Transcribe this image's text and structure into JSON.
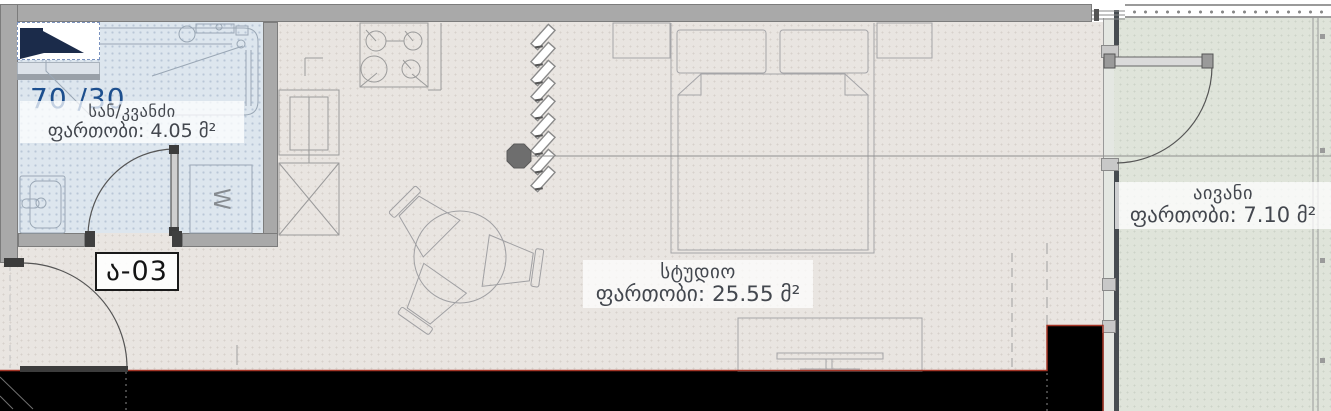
{
  "plan": {
    "unit_code": "ა-03",
    "ratio": "70 /30",
    "rooms": {
      "bathroom": {
        "name": "სან/კვანძი",
        "area": "ფართობი: 4.05 მ²"
      },
      "studio": {
        "name": "სტუდიო",
        "area": "ფართობი: 25.55 მ²"
      },
      "balcony": {
        "name": "აივანი",
        "area": "ფართობი: 7.10 მ²"
      }
    },
    "symbols": {
      "washer": "W"
    }
  },
  "colors": {
    "wall": "#a9a9a9",
    "wall-edge": "#7c7c7c",
    "floor": "#e9e5e1",
    "bath": "#dde6ee",
    "balcony": "#dfe4da",
    "mass": "#000000",
    "boundary-red": "#a53526",
    "brand-blue": "#1d4f8e",
    "label-text": "#43474e",
    "line": "#9b9b9b"
  }
}
